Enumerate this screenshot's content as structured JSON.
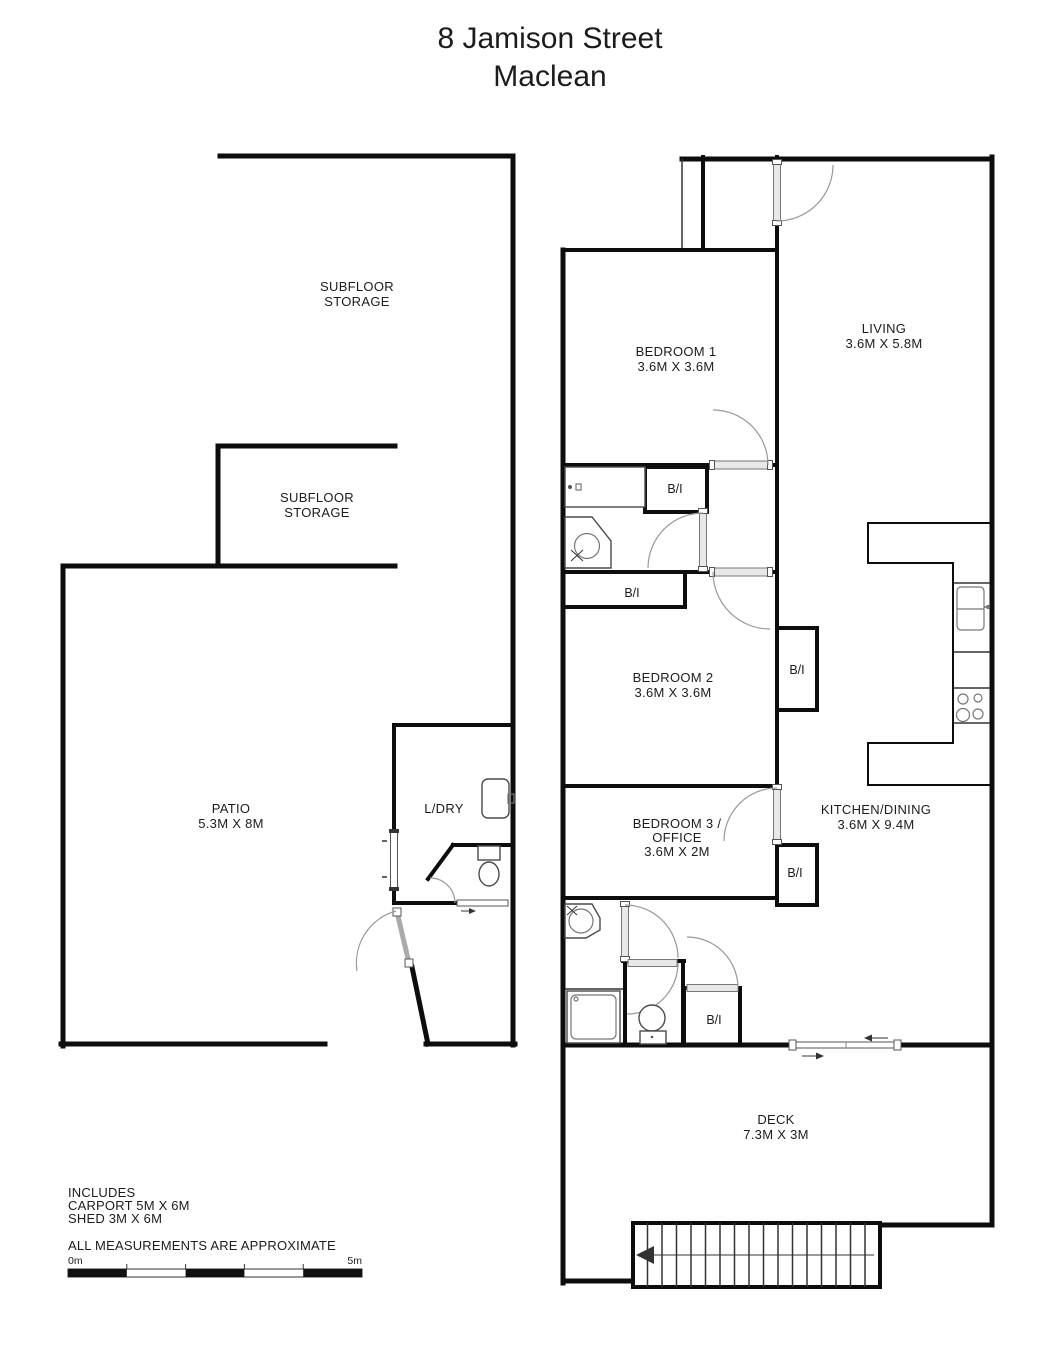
{
  "title": {
    "line1": "8 Jamison Street",
    "line2": "Maclean"
  },
  "rooms": {
    "subfloor_storage_1": {
      "name_line1": "SUBFLOOR",
      "name_line2": "STORAGE"
    },
    "subfloor_storage_2": {
      "name_line1": "SUBFLOOR",
      "name_line2": "STORAGE"
    },
    "bedroom_1": {
      "name": "BEDROOM 1",
      "dims": "3.6M X 3.6M"
    },
    "living": {
      "name": "LIVING",
      "dims": "3.6M X 5.8M"
    },
    "bedroom_2": {
      "name": "BEDROOM 2",
      "dims": "3.6M X 3.6M"
    },
    "patio": {
      "name": "PATIO",
      "dims": "5.3M X 8M"
    },
    "laundry": {
      "name": "L/DRY"
    },
    "bedroom_3": {
      "name_line1": "BEDROOM 3 /",
      "name_line2": "OFFICE",
      "dims": "3.6M X 2M"
    },
    "kitchen_dining": {
      "name": "KITCHEN/DINING",
      "dims": "3.6M X 9.4M"
    },
    "deck": {
      "name": "DECK",
      "dims": "7.3M X 3M"
    }
  },
  "labels": {
    "built_in": "B/I"
  },
  "notes": {
    "includes": "INCLUDES",
    "carport": "CARPORT 5M X 6M",
    "shed": "SHED 3M X 6M",
    "disclaimer": "ALL MEASUREMENTS ARE APPROXIMATE"
  },
  "scale_bar": {
    "start": "0m",
    "end": "5m"
  },
  "colors": {
    "wall": "#0d0d0d",
    "fixture": "#4a4a4a",
    "door_frame": "#9a9a9a",
    "text": "#1c1c1c"
  }
}
